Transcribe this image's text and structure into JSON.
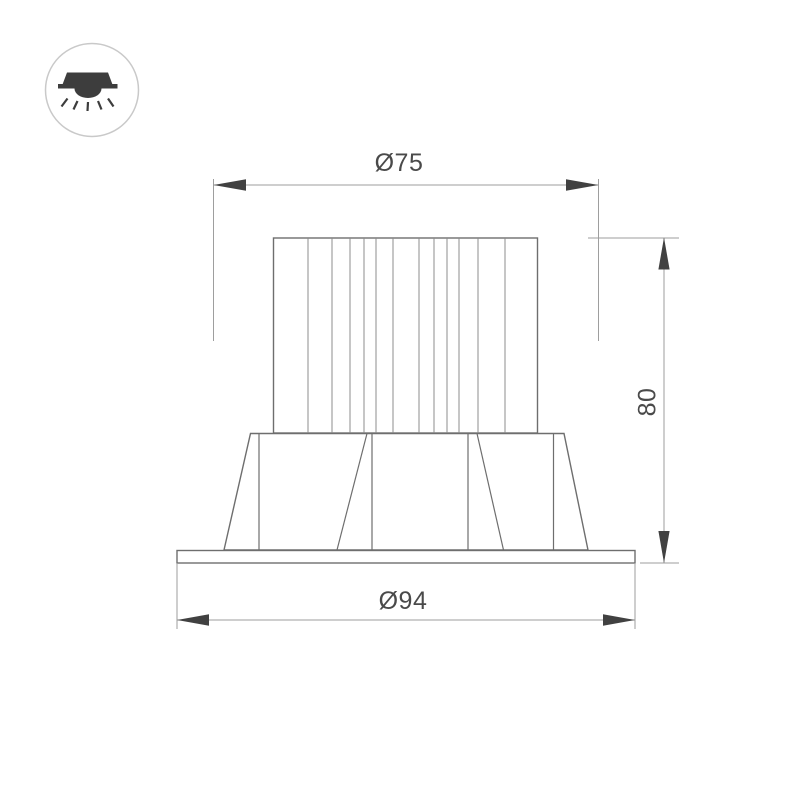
{
  "page": {
    "background": "#ffffff"
  },
  "colors": {
    "page_bg": "#ffffff",
    "object_line": "#6e6e6e",
    "fin_line": "#8c8c8c",
    "dim_line": "#9e9e9e",
    "arrow": "#414141",
    "text": "#4a4a4a",
    "icon_fill": "#3d3d3d",
    "icon_circle": "#c9c9c9"
  },
  "icon": {
    "name": "recessed-downlight-icon"
  },
  "drawing": {
    "type": "technical-dimension-drawing",
    "view": "side-elevation"
  },
  "dimensions": {
    "top_diameter": {
      "label": "Ø75",
      "value": 75
    },
    "bottom_diameter": {
      "label": "Ø94",
      "value": 94
    },
    "height": {
      "label": "80",
      "value": 80
    }
  }
}
